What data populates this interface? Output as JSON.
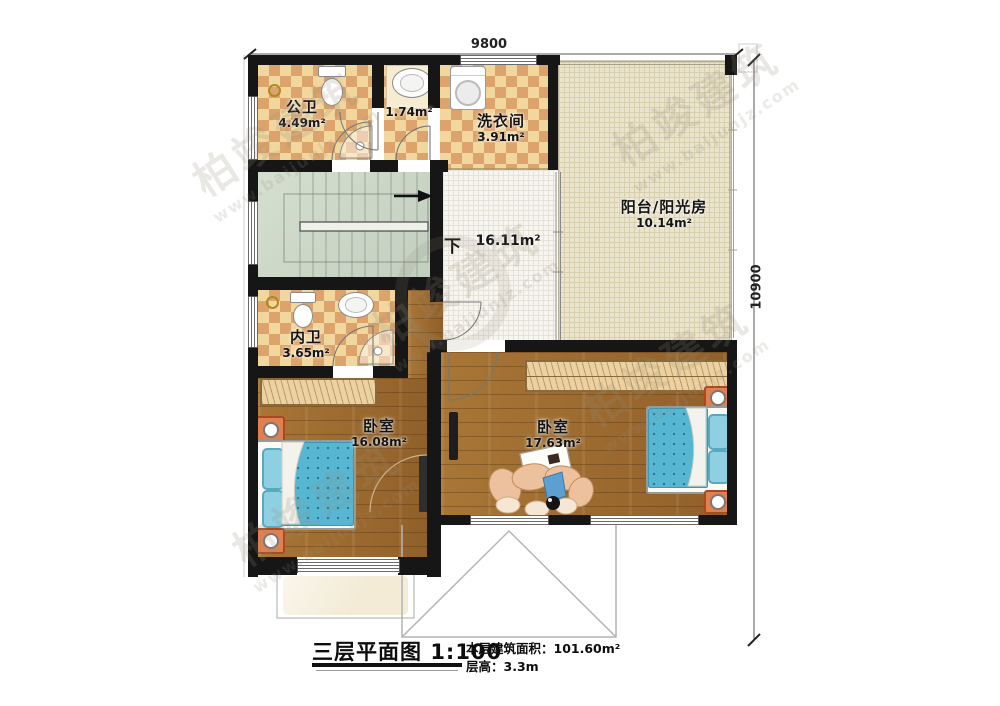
{
  "plan": {
    "dimension_top": "9800",
    "dimension_right": "10900",
    "stairs_direction": "下"
  },
  "rooms": [
    {
      "id": "public-bath",
      "name": "公卫",
      "area": "4.49m²"
    },
    {
      "id": "wash-niche",
      "name": "",
      "area": "1.74m²"
    },
    {
      "id": "laundry",
      "name": "洗衣间",
      "area": "3.91m²"
    },
    {
      "id": "sunroom",
      "name": "阳台/阳光房",
      "area": "10.14m²"
    },
    {
      "id": "hall",
      "name": "",
      "area": "16.11m²"
    },
    {
      "id": "private-bath",
      "name": "内卫",
      "area": "3.65m²"
    },
    {
      "id": "bedroom-left",
      "name": "卧室",
      "area": "16.08m²"
    },
    {
      "id": "bedroom-right",
      "name": "卧室",
      "area": "17.63m²"
    }
  ],
  "title_block": {
    "plan_title": "三层平面图",
    "scale": "1:100",
    "area_label": "本层建筑面积：",
    "area_value": "101.60m²",
    "height_label": "层高：",
    "height_value": "3.3m"
  },
  "watermark": {
    "brand": "柏竣建筑",
    "url": "www.baijunjz.com"
  },
  "colors": {
    "wall": "#161616",
    "tile_light": "#f1d69e",
    "tile_dark": "#dca46c",
    "wood": "#9e6c2d",
    "sunroom": "#ebe4cd",
    "stairs": "#ccd6c8",
    "bed_blue": "#57b7d3",
    "nightstand_orange": "#e08050"
  }
}
